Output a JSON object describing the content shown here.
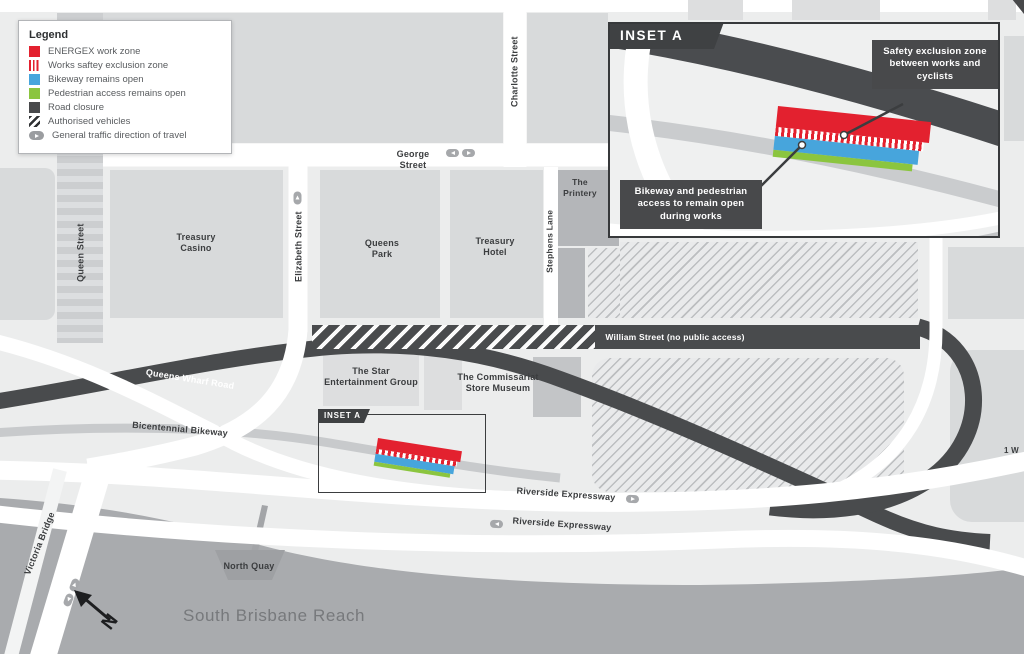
{
  "legend": {
    "title": "Legend",
    "items": [
      {
        "label": "ENERGEX work zone",
        "swatch": "solid-red",
        "color": "#e3212f"
      },
      {
        "label": "Works saftey exclusion zone",
        "swatch": "red-vertical-stripes",
        "color": "#e3212f"
      },
      {
        "label": "Bikeway remains open",
        "swatch": "solid-blue",
        "color": "#47a5dc"
      },
      {
        "label": "Pedestrian access remains open",
        "swatch": "solid-green",
        "color": "#8bc53f"
      },
      {
        "label": "Road closure",
        "swatch": "solid-dark",
        "color": "#48494b"
      },
      {
        "label": "Authorised vehicles",
        "swatch": "diagonal-hatch",
        "color": "#2f3133"
      },
      {
        "label": "General traffic direction of travel",
        "swatch": "arrow-pill",
        "color": "#9b9da0"
      }
    ]
  },
  "inset": {
    "title": "INSET A",
    "callout_safety": "Safety exclusion zone between works and cyclists",
    "callout_bikeway": "Bikeway and pedestrian access to remain open during works"
  },
  "map": {
    "inset_tag": "INSET A",
    "compass": "N",
    "streets": {
      "george": "George Street",
      "charlotte": "Charlotte Street",
      "queen": "Queen Street",
      "elizabeth": "Elizabeth Street",
      "stephens": "Stephens Lane",
      "william": "William Street (no public access)",
      "queens_wharf": "Queens Wharf Road",
      "bicentennial": "Bicentennial Bikeway",
      "riverside": "Riverside Expressway",
      "victoria": "Victoria Bridge"
    },
    "places": {
      "treasury_casino": "Treasury\nCasino",
      "queens_park": "Queens\nPark",
      "treasury_hotel": "Treasury\nHotel",
      "printery": "The\nPrintery",
      "star": "The Star\nEntertainment Group",
      "commissariat": "The Commissariat\nStore Museum",
      "north_quay": "North Quay",
      "one_william": "1 W"
    },
    "river": "South Brisbane Reach"
  },
  "colors": {
    "energex_red": "#e3212f",
    "bikeway_blue": "#47a5dc",
    "pedestrian_green": "#8bc53f",
    "road_dark": "#494b4d",
    "river_gray": "#a9abae",
    "block_gray": "#d8dadb",
    "map_bg": "#eceded"
  }
}
